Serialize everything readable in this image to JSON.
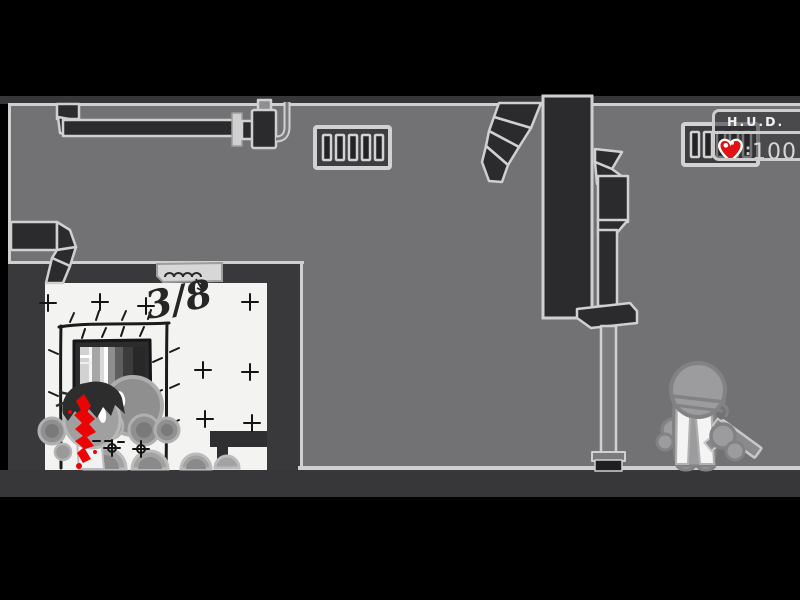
{
  "hud": {
    "title": "H.U.D.",
    "separator": ":",
    "health": "100",
    "heart_icon": "heart-icon"
  },
  "room": {
    "counter": "3/8"
  },
  "colors": {
    "background": "#000000",
    "wall": "#727274",
    "dark_band": "#37373a",
    "duct_dark": "#2b2b2d",
    "outline_light": "#d0d0d0",
    "room_white": "#f3f3f1",
    "sketch_ink": "#1b1b1b",
    "blood_red": "#ec0404",
    "heart_red": "#e01212",
    "body_gray": "#9c9c9e",
    "body_outline": "#828284"
  }
}
